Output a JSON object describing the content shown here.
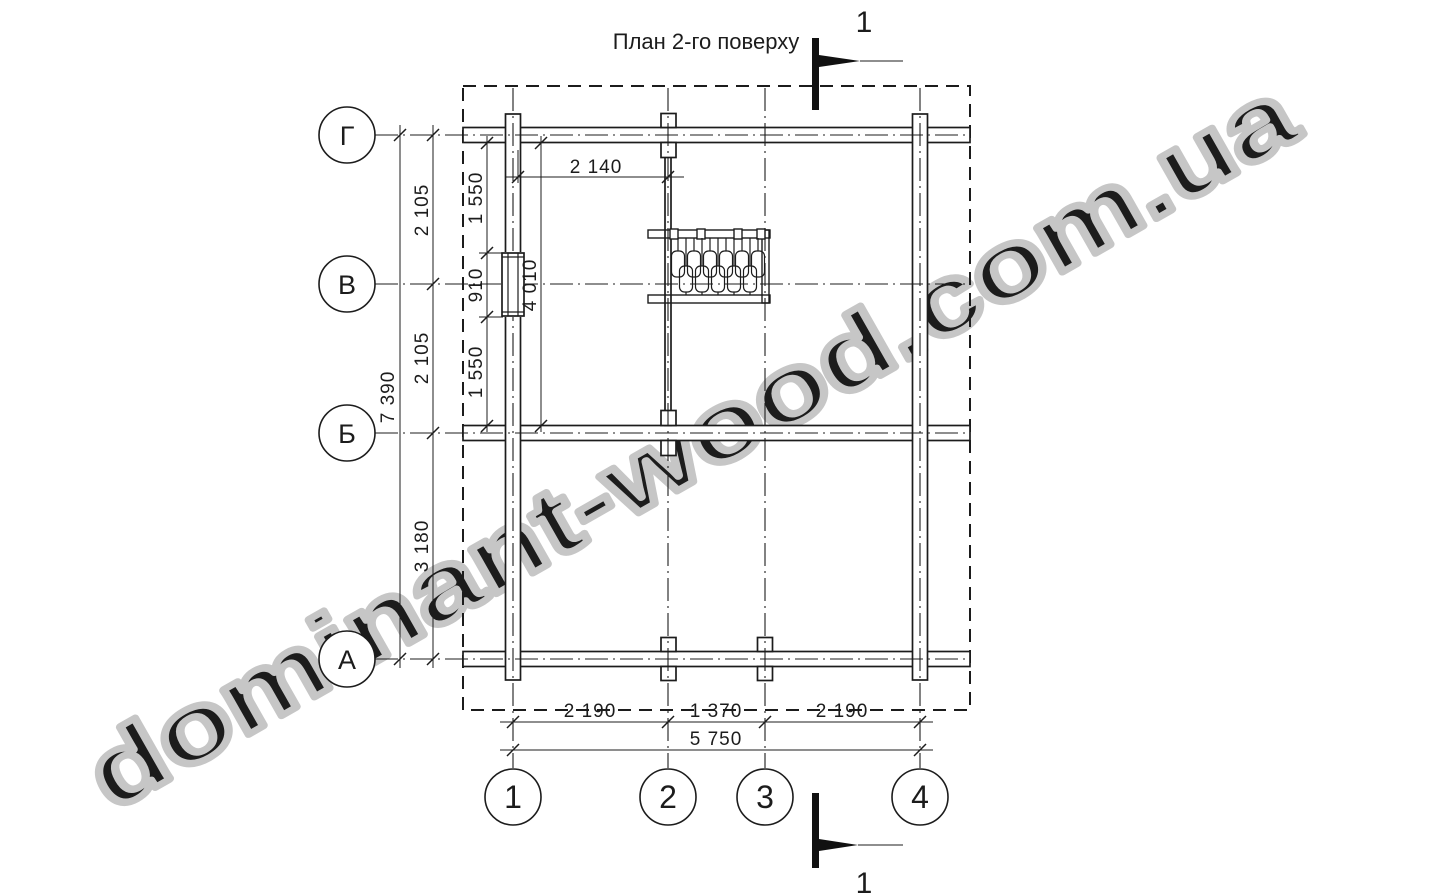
{
  "title": "План 2-го поверху",
  "watermark": "dominant-wood.com.ua",
  "section_marks": {
    "top_label": "1",
    "bottom_label": "1"
  },
  "axes": {
    "rows": [
      {
        "label": "Г"
      },
      {
        "label": "В"
      },
      {
        "label": "Б"
      },
      {
        "label": "А"
      }
    ],
    "columns": [
      {
        "label": "1"
      },
      {
        "label": "2"
      },
      {
        "label": "3"
      },
      {
        "label": "4"
      }
    ]
  },
  "dimensions": {
    "left_overall": "7 390",
    "left_chain": [
      "2 105",
      "2 105",
      "3 180"
    ],
    "inner_vertical_chain": [
      "1 550",
      "910",
      "1 550"
    ],
    "inner_vertical_overall": "4 010",
    "top_inner": "2 140",
    "bottom_chain": [
      "2 190",
      "1 370",
      "2 190"
    ],
    "bottom_overall": "5 750"
  },
  "colors": {
    "line": "#1c1c1c",
    "watermark": "#c6c6c6",
    "background": "#ffffff"
  }
}
